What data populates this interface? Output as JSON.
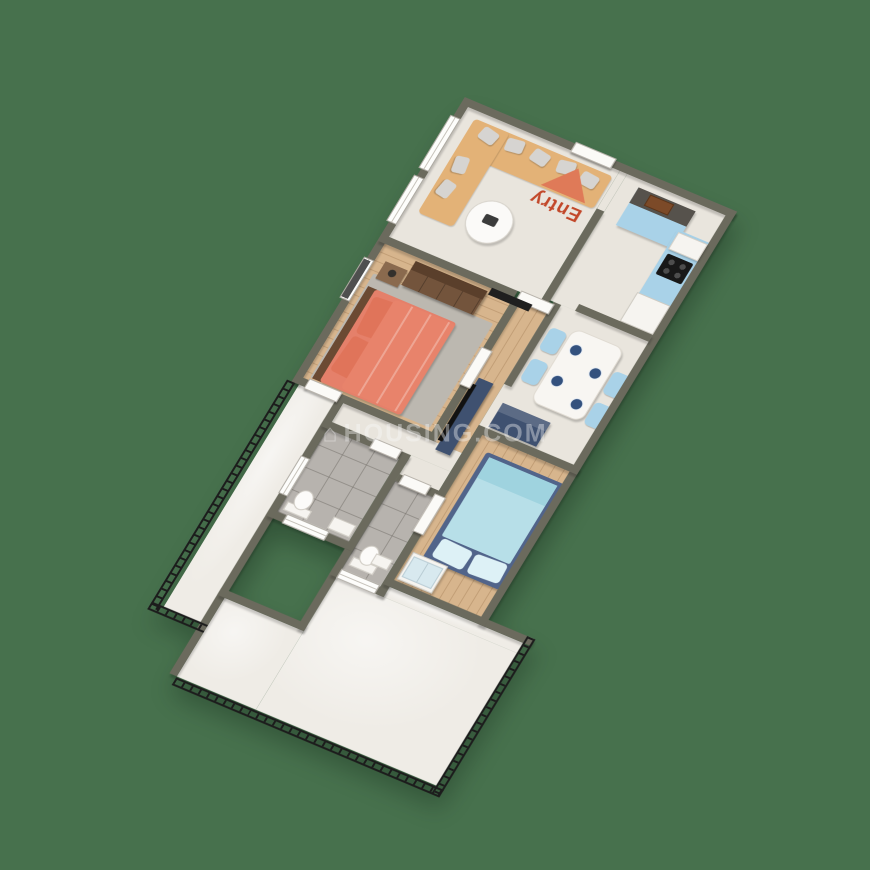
{
  "entry_marker": {
    "label": "Entry",
    "arrow_color": "#df7a58",
    "label_color": "#c2482a"
  },
  "watermark": {
    "icon": "house-icon",
    "text": "HOUSING.COM"
  },
  "colors": {
    "background": "#47714d",
    "wall_top": "#6b6a5d",
    "marble_floor": "#e9e5dd",
    "wood_floor": "#d7b58d",
    "bathroom_tile": "#b7b3ae",
    "balcony_floor": "#efece6",
    "railing": "#1c1c1c",
    "sofa": "#e3b277",
    "kitchen_cabinets": "#a9d2e8",
    "dining_chairs": "#a9d2e8",
    "master_bed": "#e8836b",
    "guest_bed": "#b7dfe8",
    "navy_furniture": "#3f5170",
    "wardrobe_brown": "#73543c"
  }
}
